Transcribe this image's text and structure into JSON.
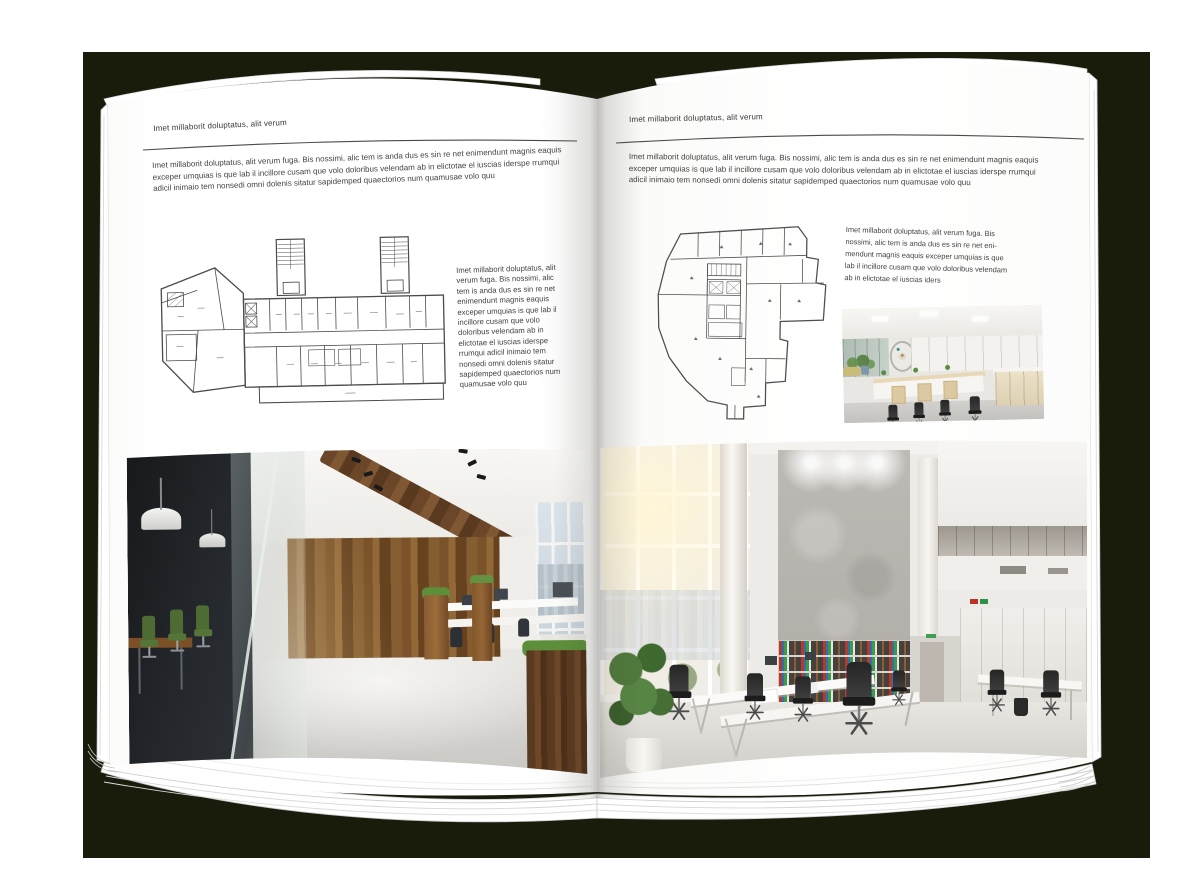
{
  "colors": {
    "backdrop": "#191b0b",
    "page": "#ffffff",
    "text": "#3e3e3e",
    "wood_accent": "#7b5229",
    "chair_green": "#4e6b33"
  },
  "left_page": {
    "header": "Imet millaborit doluptatus, alit verum",
    "intro": "Imet millaborit doluptatus, alit verum fuga. Bis nossimi, alic tem is anda dus es sin re net enimendunt magnis eaquis exceper umquias is que lab il incillore cusam que volo doloribus velendam ab in elictotae el iuscias iderspe rrumqui adicil inimaio tem nonsedi omni dolenis sitatur sapidemped quaectorios num quamusae volo quu",
    "caption": "Imet millaborit doluptatus, alit verum fuga. Bis nossimi, alic tem is anda dus es sin re net enimendunt magnis eaquis exceper umquias is que lab il incillore cusam que volo doloribus velendam ab in elictotae el iuscias iderspe rrumqui adicil inimaio tem nonsedi omni dolenis sitatur sapidemped quaectorios num quamusae volo quu"
  },
  "right_page": {
    "header": "Imet millaborit doluptatus, alit verum",
    "intro": "Imet millaborit doluptatus, alit verum fuga. Bis nossimi, alic tem is anda dus es sin re net enimendunt magnis eaquis exceper umquias is que lab il incillore cusam que volo doloribus velendam ab in elictotae el iuscias iderspe rrumqui adicil inimaio tem nonsedi omni dolenis sitatur sapidemped quaectorios num quamusae volo quu",
    "caption": "Imet millaborit doluptatus, alit verum fuga. Bis nossimi, alic tem is anda dus es sin re net eni-mendunt magnis eaquis exceper umquias is que lab il incillore cusam que volo doloribus velendam ab in elictotae el iuscias iders"
  },
  "images": {
    "left_floor_plan": "architectural-floor-plan",
    "right_floor_plan": "architectural-floor-plan",
    "left_photo": "office-interior-photo-dark-loft",
    "right_photo": "office-interior-photo-bright-atrium",
    "small_photo": "office-interior-photo-open-space"
  }
}
